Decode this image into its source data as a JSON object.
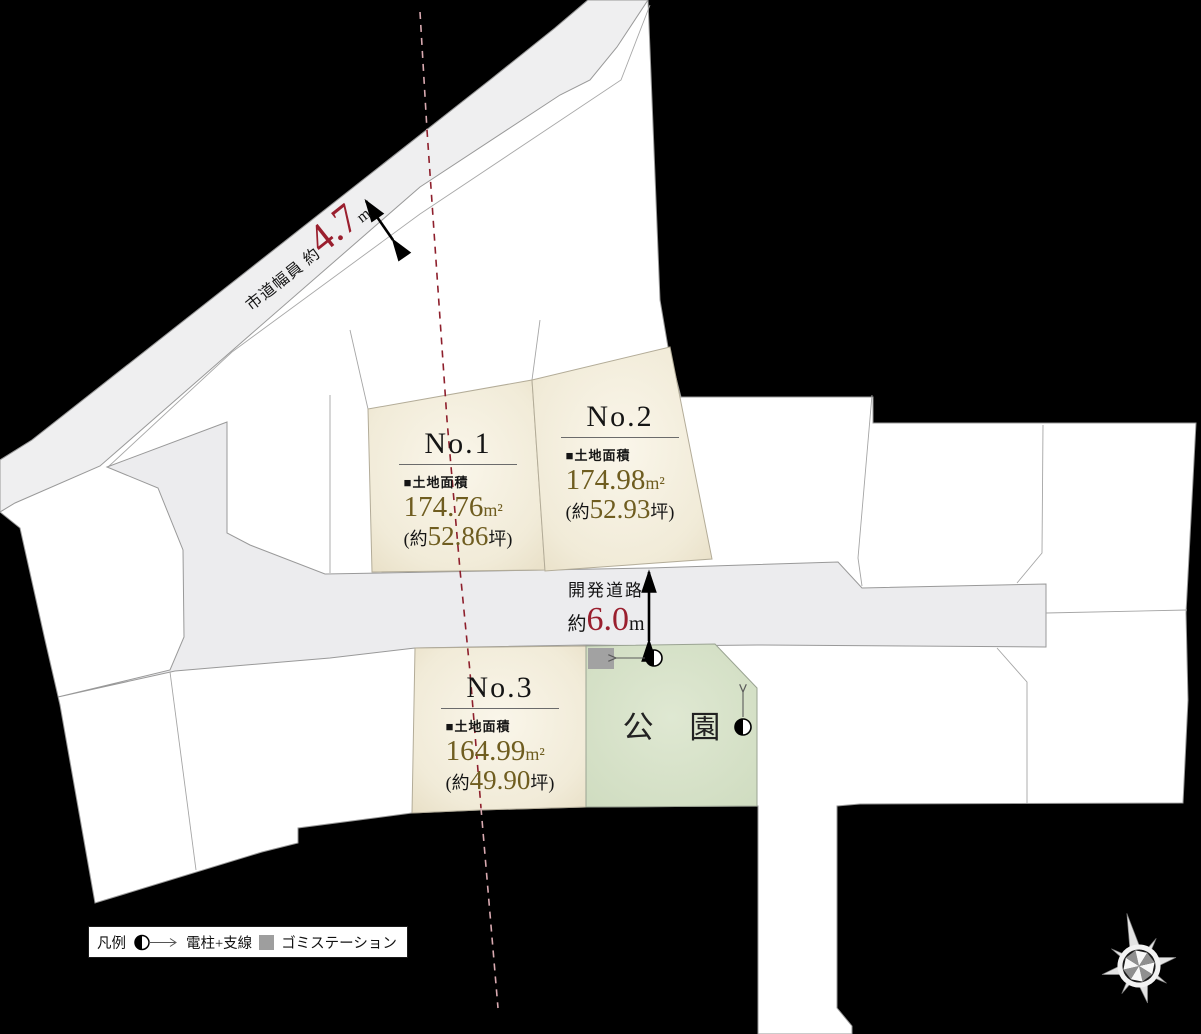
{
  "map": {
    "title_hint": "land lot layout map",
    "city_road": {
      "label": "市道幅員",
      "approx": "約",
      "value": "4.7",
      "unit": "m"
    },
    "dev_road": {
      "name": "開発道路",
      "approx": "約",
      "value": "6.0",
      "unit": "m"
    },
    "park_label": "公 園",
    "lots": [
      {
        "no": "No.1",
        "area_title": "■土地面積",
        "m2": "174.76",
        "m2_unit": "m²",
        "tsubo_open": "(約",
        "tsubo": "52.86",
        "tsubo_close": "坪)"
      },
      {
        "no": "No.2",
        "area_title": "■土地面積",
        "m2": "174.98",
        "m2_unit": "m²",
        "tsubo_open": "(約",
        "tsubo": "52.93",
        "tsubo_close": "坪)"
      },
      {
        "no": "No.3",
        "area_title": "■土地面積",
        "m2": "164.99",
        "m2_unit": "m²",
        "tsubo_open": "(約",
        "tsubo": "49.90",
        "tsubo_close": "坪)"
      }
    ],
    "legend": {
      "title": "凡例",
      "pole_label": "電柱+支線",
      "garbage_label": "ゴミステーション"
    },
    "icons": {
      "pole": "utility-pole-icon",
      "garbage": "garbage-station-icon",
      "compass": "compass-rose-icon"
    },
    "colors": {
      "accent_red": "#9a1f2e",
      "gold": "#6f5d20",
      "cream": "#f3eedd",
      "park_green": "#d9e3cc",
      "road_gray": "#ececed",
      "background": "#000000"
    }
  }
}
